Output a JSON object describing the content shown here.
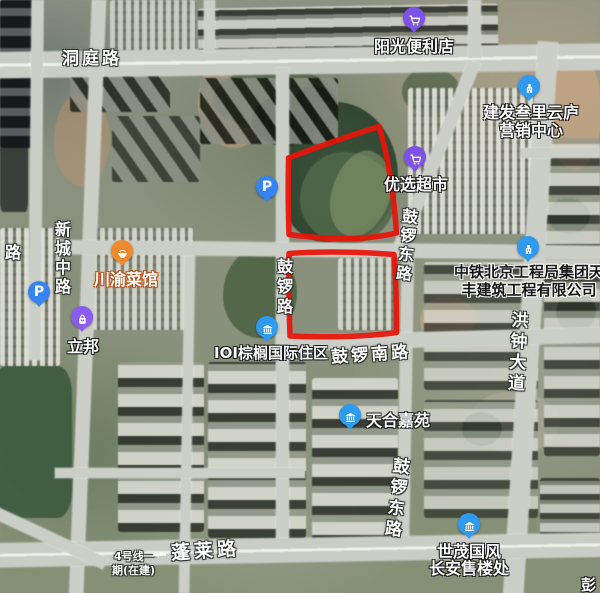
{
  "app": {
    "type": "satellite-map"
  },
  "road_labels": {
    "dongting": "洞庭路",
    "xinchengzhong": "新城中路",
    "gulu": "鼓锣路",
    "guluodong_mid": "鼓锣东路",
    "guluonan": "鼓锣南路",
    "hongzhong_dadao": "洪钟大道",
    "guluodong_south": "鼓锣东路",
    "penglai": "蓬莱路",
    "metro_line1": "4号线一",
    "metro_line2": "期(在建)",
    "edge_partial": "路"
  },
  "pois": {
    "yangguang": {
      "name": "阳光便利店"
    },
    "jianfa": {
      "line1": "建发叁里云庐",
      "line2": "营销中心"
    },
    "youxuan": {
      "name": "优选超市"
    },
    "chuanyu": {
      "name": "川渝菜馆"
    },
    "libang": {
      "name": "立邦"
    },
    "ioi": {
      "name": "IOI棕榈国际住区"
    },
    "zhongtie": {
      "line1": "中铁北京工程局集团天",
      "line2": "丰建筑工程有限公司"
    },
    "tianhe": {
      "name": "天合嘉苑"
    },
    "shimao": {
      "line1": "世茂国风",
      "line2": "长安售楼处"
    },
    "peng_partial": {
      "name": "彭"
    }
  },
  "markers": {
    "parking_label": "P"
  },
  "colors": {
    "boundary_red": "#e91309",
    "poi_blue": "#2e9af0",
    "poi_purple": "#7d52e8",
    "poi_orange": "#f08a2e",
    "parking_blue": "#3584f2"
  }
}
